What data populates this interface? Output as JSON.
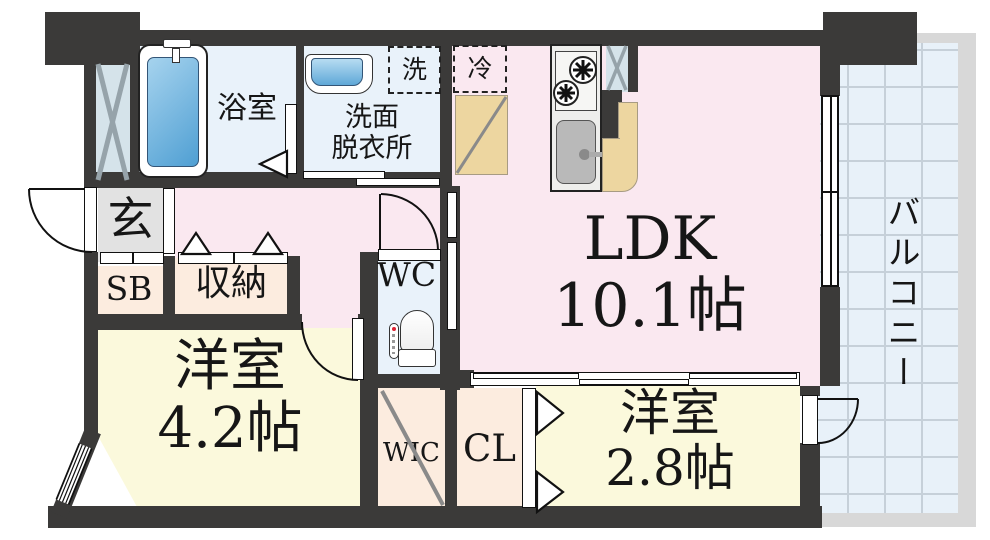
{
  "floorplan": {
    "colors": {
      "wall": "#3b3a39",
      "pink": "#fae8f0",
      "cream": "#fbf9dc",
      "peach": "#fcecdf",
      "wet": "#e9f2fa",
      "ps": "#d5e3ea",
      "genkan": "#e2e2e2",
      "tile": "#e8f1f9",
      "tile_line": "#c6d0d9",
      "concrete": "#d8d8d8",
      "counter": "#edd6a0",
      "ink": "#161616"
    },
    "rooms": {
      "ldk": {
        "name": "LDK",
        "size": "10.1帖"
      },
      "western1": {
        "name": "洋室",
        "size": "4.2帖"
      },
      "western2": {
        "name": "洋室",
        "size": "2.8帖"
      },
      "bath": {
        "name": "浴室"
      },
      "washroom": {
        "name_line1": "洗面",
        "name_line2": "脱衣所"
      },
      "wc": {
        "name": "WC"
      },
      "entrance": {
        "name": "玄"
      },
      "shoe_box": {
        "name": "SB"
      },
      "storage": {
        "name": "収納"
      },
      "wic": {
        "name": "WIC"
      },
      "closet": {
        "name": "CL"
      },
      "balcony": {
        "name": "バルコニー"
      },
      "washer_space": {
        "name": "洗"
      },
      "fridge_space": {
        "name": "冷"
      }
    }
  }
}
